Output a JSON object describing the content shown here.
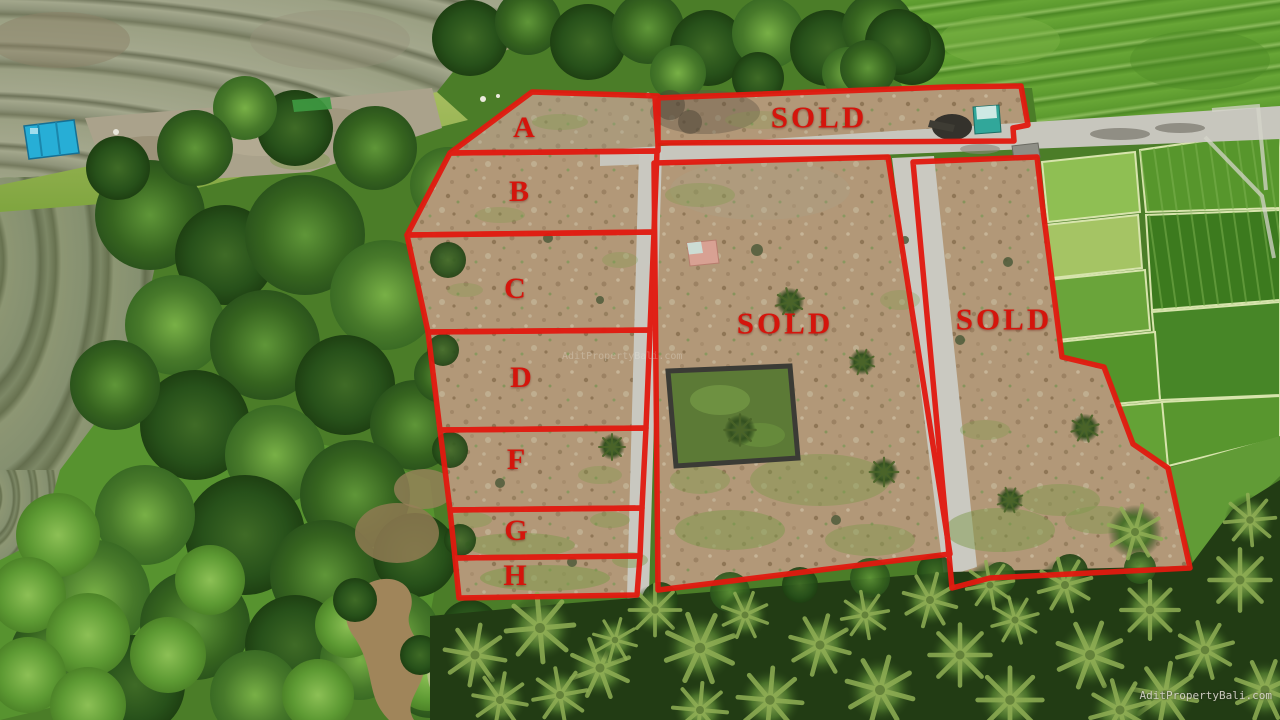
{
  "overlay": {
    "boundary_color": "#e2190f",
    "label_color": "#d4150c",
    "plots": [
      {
        "id": "A",
        "label": "A"
      },
      {
        "id": "B",
        "label": "B"
      },
      {
        "id": "C",
        "label": "C"
      },
      {
        "id": "D",
        "label": "D"
      },
      {
        "id": "F",
        "label": "F"
      },
      {
        "id": "G",
        "label": "G"
      },
      {
        "id": "H",
        "label": "H"
      }
    ],
    "sold_labels": [
      {
        "area": "top",
        "label": "SOLD"
      },
      {
        "area": "middle",
        "label": "SOLD"
      },
      {
        "area": "right",
        "label": "SOLD"
      }
    ]
  },
  "watermarks": {
    "corner": "AditPropertyBali.com",
    "faint_center": "AditPropertyBali.com"
  }
}
